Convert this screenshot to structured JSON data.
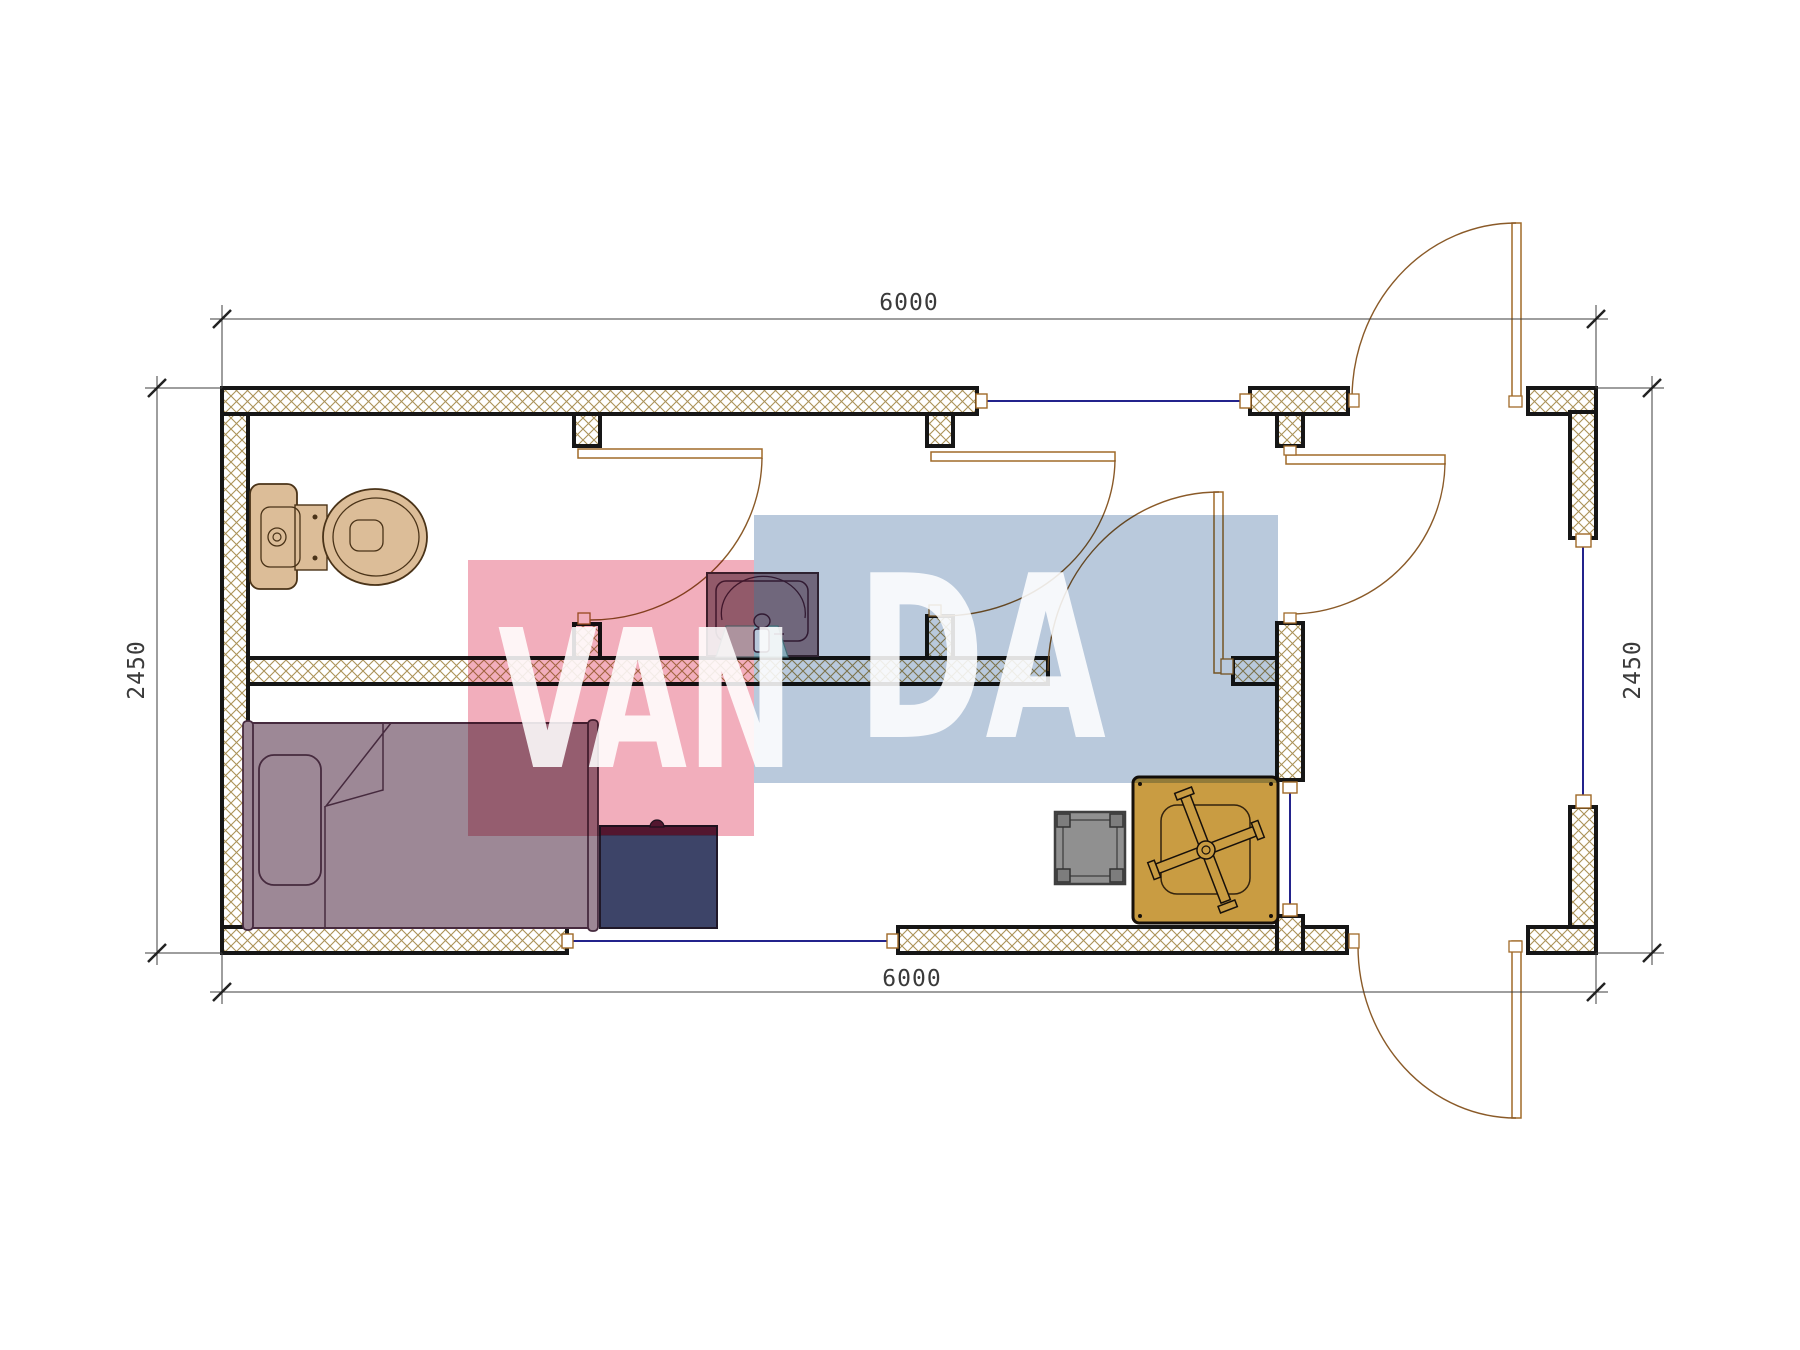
{
  "page": {
    "background": "#ffffff",
    "kind": "architectural floor plan drawing"
  },
  "dimensions": {
    "top": "6000",
    "bottom": "6000",
    "left": "2450",
    "right": "2450"
  },
  "watermark": {
    "text": "VANDA",
    "van": "VAN",
    "da": "DA",
    "pink_block": "#f2aebc",
    "blue_block": "#b9c9dc",
    "letter_color": "#ffffff"
  },
  "plan": {
    "wall_hatch_line": "#ab9258",
    "wall_outline": "#161616",
    "window_color": "#23238c",
    "door_color": "#8a5a28",
    "dimension_color": "#3a3a3a",
    "furniture": [
      {
        "name": "toilet",
        "room": "bathroom",
        "color": "#dcbd98"
      },
      {
        "name": "sink",
        "room": "bathroom",
        "color": "#9a8390"
      },
      {
        "name": "single-bed",
        "room": "bedroom",
        "color": "#9d8896"
      },
      {
        "name": "desk",
        "room": "bedroom",
        "color": "#3d4468"
      },
      {
        "name": "stool",
        "room": "living-area",
        "color": "#909090"
      },
      {
        "name": "table-x-base",
        "room": "living-area",
        "color": "#c99c42"
      }
    ]
  }
}
